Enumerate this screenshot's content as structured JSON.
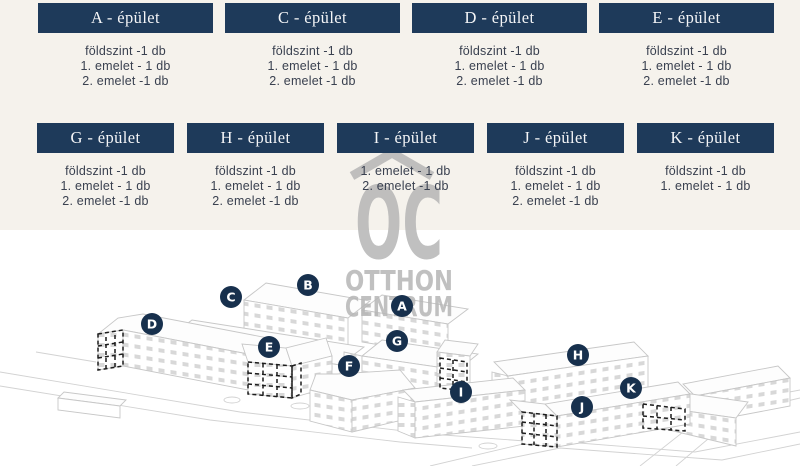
{
  "cards": {
    "row1": [
      {
        "title": "A - épület",
        "floors": [
          "földszint -1 db",
          "1. emelet - 1 db",
          "2. emelet -1 db"
        ]
      },
      {
        "title": "C - épület",
        "floors": [
          "földszint -1 db",
          "1. emelet - 1 db",
          "2. emelet -1 db"
        ]
      },
      {
        "title": "D - épület",
        "floors": [
          "földszint -1 db",
          "1. emelet - 1 db",
          "2. emelet -1 db"
        ]
      },
      {
        "title": "E - épület",
        "floors": [
          "földszint -1 db",
          "1. emelet - 1 db",
          "2. emelet -1 db"
        ]
      }
    ],
    "row2": [
      {
        "title": "G - épület",
        "floors": [
          "földszint -1 db",
          "1. emelet - 1 db",
          "2. emelet -1 db"
        ]
      },
      {
        "title": "H - épület",
        "floors": [
          "földszint -1 db",
          "1. emelet - 1 db",
          "2. emelet -1 db"
        ]
      },
      {
        "title": "I - épület",
        "floors": [
          "1. emelet - 1 db",
          "2. emelet -1 db"
        ]
      },
      {
        "title": "J - épület",
        "floors": [
          "földszint -1 db",
          "1. emelet - 1 db",
          "2. emelet -1 db"
        ]
      },
      {
        "title": "K - épület",
        "floors": [
          "földszint -1 db",
          "1. emelet - 1 db"
        ]
      }
    ]
  },
  "watermark": {
    "monogram": "OC",
    "name_line1": "OTTHON",
    "name_line2": "CENTRUM"
  },
  "site_plan": {
    "markers": [
      {
        "label": "A",
        "x": 402,
        "y": 306
      },
      {
        "label": "B",
        "x": 308,
        "y": 285
      },
      {
        "label": "C",
        "x": 231,
        "y": 297
      },
      {
        "label": "D",
        "x": 152,
        "y": 324
      },
      {
        "label": "E",
        "x": 269,
        "y": 347
      },
      {
        "label": "F",
        "x": 349,
        "y": 366
      },
      {
        "label": "G",
        "x": 397,
        "y": 341
      },
      {
        "label": "H",
        "x": 578,
        "y": 355
      },
      {
        "label": "I",
        "x": 461,
        "y": 392
      },
      {
        "label": "J",
        "x": 582,
        "y": 407
      },
      {
        "label": "K",
        "x": 631,
        "y": 388
      }
    ]
  },
  "colors": {
    "accent_navy": "#1e3a5a",
    "badge_navy": "#17304d",
    "cream_bg": "#f5f2ec",
    "highlight_yellow": "#eae4a2",
    "logo_gray": "#b5b5b5"
  }
}
